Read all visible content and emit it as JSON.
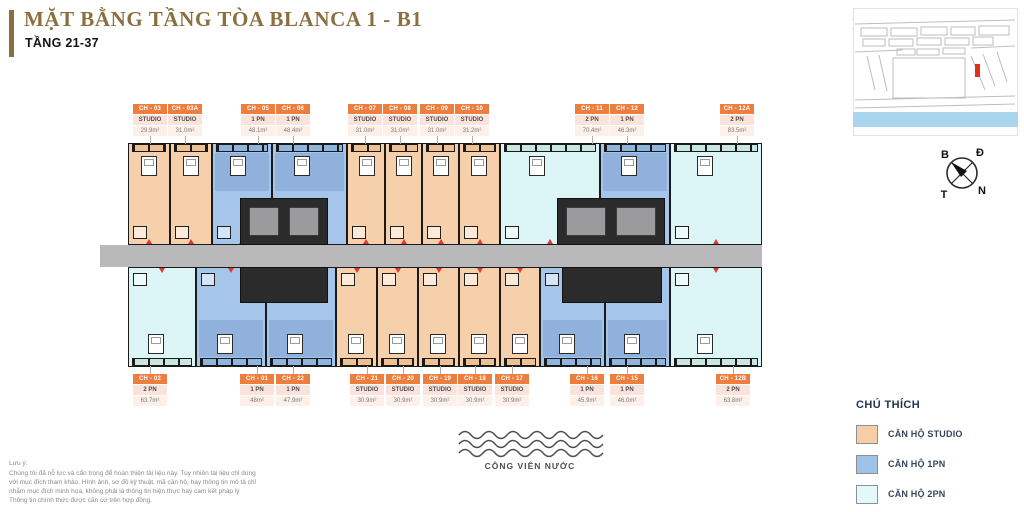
{
  "header": {
    "title": "MẶT BẰNG TẦNG TÒA BLANCA 1 - B1",
    "subtitle": "TẦNG 21-37",
    "accent_color": "#8c6f3f"
  },
  "compass": {
    "north": "B",
    "east": "Đ",
    "south": "N",
    "west": "T"
  },
  "site_map": {
    "sea_color": "#a9d6ee",
    "marker_color": "#e0301e"
  },
  "plan": {
    "types": {
      "STUDIO": "#f6d0ab",
      "1 PN": "#a5c6ea",
      "2 PN": "#dcf5f7"
    },
    "balcony_tints": {
      "STUDIO": "#eec092",
      "1 PN": "#8fb4dd",
      "2 PN": "#c9e7e0"
    },
    "corridor": {
      "x": 100,
      "y": 245,
      "w": 662,
      "h": 22
    },
    "corridor_color": "#b9b9bb",
    "cores": [
      {
        "x": 240,
        "y": 198,
        "w": 88,
        "h": 47,
        "cells": true
      },
      {
        "x": 240,
        "y": 267,
        "w": 88,
        "h": 36,
        "cells": false
      },
      {
        "x": 557,
        "y": 198,
        "w": 108,
        "h": 47,
        "cells": true
      },
      {
        "x": 562,
        "y": 267,
        "w": 100,
        "h": 36,
        "cells": false
      }
    ],
    "top_units": [
      {
        "code": "CH - 03",
        "type": "STUDIO",
        "area": "29.9m²",
        "x": 128,
        "w": 42,
        "lx": 150
      },
      {
        "code": "CH - 03A",
        "type": "STUDIO",
        "area": "31.0m²",
        "x": 170,
        "w": 42,
        "lx": 185
      },
      {
        "code": "CH - 05",
        "type": "1 PN",
        "area": "48.1m²",
        "x": 212,
        "w": 60,
        "lx": 258
      },
      {
        "code": "CH - 06",
        "type": "1 PN",
        "area": "48.4m²",
        "x": 272,
        "w": 75,
        "lx": 293
      },
      {
        "code": "CH - 07",
        "type": "STUDIO",
        "area": "31.0m²",
        "x": 347,
        "w": 38,
        "lx": 365
      },
      {
        "code": "CH - 08",
        "type": "STUDIO",
        "area": "31.0m²",
        "x": 385,
        "w": 37,
        "lx": 400
      },
      {
        "code": "CH - 09",
        "type": "STUDIO",
        "area": "31.0m²",
        "x": 422,
        "w": 37,
        "lx": 437
      },
      {
        "code": "CH - 10",
        "type": "STUDIO",
        "area": "31.2m²",
        "x": 459,
        "w": 41,
        "lx": 472
      },
      {
        "code": "CH - 11",
        "type": "2 PN",
        "area": "70.4m²",
        "x": 500,
        "w": 100,
        "lx": 592
      },
      {
        "code": "CH - 12",
        "type": "1 PN",
        "area": "46.3m²",
        "x": 600,
        "w": 70,
        "lx": 627
      },
      {
        "code": "CH - 12A",
        "type": "2 PN",
        "area": "83.5m²",
        "x": 670,
        "w": 92,
        "lx": 737
      }
    ],
    "bottom_units": [
      {
        "code": "CH - 02",
        "type": "2 PN",
        "area": "63.7m²",
        "x": 128,
        "w": 68,
        "lx": 150
      },
      {
        "code": "CH - 01",
        "type": "1 PN",
        "area": "48m²",
        "x": 196,
        "w": 70,
        "lx": 257
      },
      {
        "code": "CH - 22",
        "type": "1 PN",
        "area": "47.9m²",
        "x": 266,
        "w": 70,
        "lx": 293
      },
      {
        "code": "CH - 21",
        "type": "STUDIO",
        "area": "30.9m²",
        "x": 336,
        "w": 41,
        "lx": 367
      },
      {
        "code": "CH - 20",
        "type": "STUDIO",
        "area": "30.9m²",
        "x": 377,
        "w": 41,
        "lx": 403
      },
      {
        "code": "CH - 19",
        "type": "STUDIO",
        "area": "30.9m²",
        "x": 418,
        "w": 41,
        "lx": 440
      },
      {
        "code": "CH - 18",
        "type": "STUDIO",
        "area": "30.9m²",
        "x": 459,
        "w": 41,
        "lx": 475
      },
      {
        "code": "CH - 17",
        "type": "STUDIO",
        "area": "30.9m²",
        "x": 500,
        "w": 40,
        "lx": 512
      },
      {
        "code": "CH - 16",
        "type": "1 PN",
        "area": "45.9m²",
        "x": 540,
        "w": 65,
        "lx": 587
      },
      {
        "code": "CH - 15",
        "type": "1 PN",
        "area": "46.0m²",
        "x": 605,
        "w": 65,
        "lx": 627
      },
      {
        "code": "CH - 12B",
        "type": "2 PN",
        "area": "63.8m²",
        "x": 670,
        "w": 92,
        "lx": 733
      }
    ]
  },
  "legend": {
    "title": "CHÚ THÍCH",
    "items": [
      {
        "label": "CĂN HỘ STUDIO",
        "color": "#f6cda6"
      },
      {
        "label": "CĂN HỘ 1PN",
        "color": "#9ec3e8"
      },
      {
        "label": "CĂN HỘ 2PN",
        "color": "#e2f8fa"
      }
    ]
  },
  "water_park": {
    "label": "CÔNG VIÊN NƯỚC"
  },
  "disclaimer": {
    "title": "Lưu ý:",
    "lines": [
      "Chúng tôi đã nỗ lực và cẩn trọng để hoàn thiện tài liệu này. Tuy nhiên tài liệu chỉ dùng",
      "với mục đích tham khảo. Hình ảnh, sơ đồ kỹ thuật, mã căn hộ, hay thông tin mô tả chỉ",
      "nhằm mục đích minh họa, không phải là thông tin hiện thực hay cam kết pháp lý",
      "Thông tin chính thức được căn cứ trên hợp đồng."
    ]
  }
}
